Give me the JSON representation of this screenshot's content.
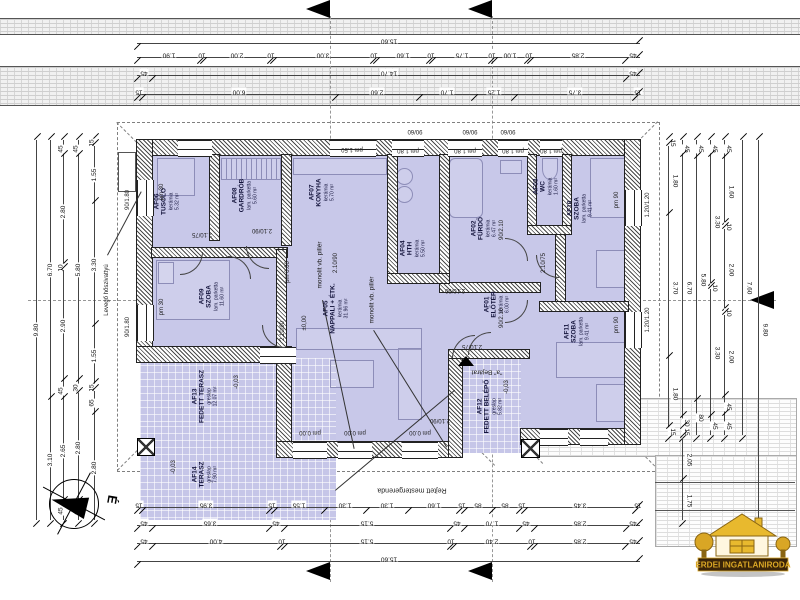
{
  "rooms": [
    {
      "code": "AF01",
      "name": "ELŐTÉR",
      "floor": "kerámia",
      "area": "6.00 m²"
    },
    {
      "code": "AF02",
      "name": "FÜRDŐ",
      "floor": "kerámia",
      "area": "6.47 m²"
    },
    {
      "code": "AF03",
      "name": "WC",
      "floor": "kerámia",
      "area": "1.60 m²"
    },
    {
      "code": "AF04",
      "name": "HTH",
      "floor": "kerámia",
      "area": "5.50 m²"
    },
    {
      "code": "AF05",
      "name": "NAPPALI + ÉTK.",
      "floor": "kerámia",
      "area": "31.96 m²"
    },
    {
      "code": "AF06",
      "name": "TUSOLÓ",
      "floor": "kerámia",
      "area": "5.32 m²"
    },
    {
      "code": "AF07",
      "name": "KONYHA",
      "floor": "kerámia",
      "area": "5.70 m²"
    },
    {
      "code": "AF08",
      "name": "GARDRÓB",
      "floor": "lam. parketta",
      "area": "5.60 m²"
    },
    {
      "code": "AF09",
      "name": "SZOBA",
      "floor": "lam. parketta",
      "area": "11.60 m²"
    },
    {
      "code": "AF10",
      "name": "SZOBA",
      "floor": "lam. parketta",
      "area": "9.41 m²"
    },
    {
      "code": "AF11",
      "name": "SZOBA",
      "floor": "lam. parketta",
      "area": "9.41 m²"
    },
    {
      "code": "AF12",
      "name": "FEDETT BELÉPŐ",
      "floor": "greslap",
      "area": "5.82 m²"
    },
    {
      "code": "AF13",
      "name": "FEDETT TERASZ",
      "floor": "greslap",
      "area": "12.07 m²"
    },
    {
      "code": "AF14",
      "name": "TERASZ",
      "floor": "greslap",
      "area": "7.90 m²"
    }
  ],
  "annotations": {
    "pillar": "monolit vb. pillér",
    "heat_pump": "Levegő hőszivattyú",
    "hidden_beam": "Rejtett mestergerenda",
    "entrance": "\"a\" Bejárat",
    "north": "É"
  },
  "small_labels": [
    "pm 1.50",
    "pm 1.80",
    "pm 1.80",
    "pm 1.80",
    "pm 1.80",
    "90/60",
    "90/60",
    "90/60",
    "pm 30",
    "pm 30",
    "pm 90",
    "pm 90",
    "90/1.80",
    "90/1.80",
    "pm 0.00",
    "pm 0.00",
    "pm 0.00",
    "pm 0.00",
    "±0,00",
    "-0,03",
    "-0,03",
    "-0,03",
    "2.10/75",
    "2.10/90",
    "2.10/90",
    "2.10/75",
    "2.10/75",
    "2.10/90",
    "2.10/90",
    "90/2.10",
    "90/2.10",
    "1.20/1.20",
    "1.20/1.20",
    "2.10/90"
  ],
  "dims": {
    "top_total": [
      "15.60"
    ],
    "top_a": [
      "1.90",
      "10",
      "2.00",
      "10",
      "3.00",
      "10",
      "1.60",
      "10",
      "1.75",
      "10",
      "1.00",
      "10",
      "2.85",
      "45"
    ],
    "top_b": [
      "45",
      "14.70",
      "45"
    ],
    "top_c": [
      "15",
      "6.00",
      "2.60",
      "1.70",
      "1.25",
      "3.75",
      "15"
    ],
    "bottom_1": [
      "15",
      "3.95",
      "15",
      "1.55",
      "1.30",
      "1.30",
      "1.60",
      "15",
      "85",
      "85",
      "15",
      "3.45",
      "15"
    ],
    "bottom_2": [
      "45",
      "3.65",
      "45",
      "5.15",
      "45",
      "1.70",
      "45",
      "2.85",
      "45"
    ],
    "bottom_3": [
      "45",
      "4.00",
      "10",
      "5.15",
      "10",
      "2.40",
      "10",
      "2.85",
      "45"
    ],
    "bottom_total": [
      "15.60"
    ],
    "left_1": [
      "9.80"
    ],
    "left_2": [
      "6.70",
      "3.10"
    ],
    "left_3": [
      "45",
      "2.80",
      "10",
      "2.90",
      "45",
      "2.65",
      "45"
    ],
    "left_4": [
      "45",
      "5.80",
      "30",
      "2.80",
      "45"
    ],
    "left_5": [
      "15",
      "1.55",
      "3.30",
      "1.55",
      "15",
      "65",
      "2.80"
    ],
    "right_1": [
      "15",
      "1.80",
      "3.70",
      "1.80",
      "15"
    ],
    "right_2": [
      "45",
      "6.70",
      "30",
      "15"
    ],
    "right_2b": [
      "2.05",
      "1.75"
    ],
    "right_3": [
      "45",
      "5.80",
      "80"
    ],
    "right_4": [
      "45",
      "3.30",
      "10",
      "3.30",
      "45"
    ],
    "right_5": [
      "45",
      "1.60",
      "10",
      "2.00",
      "10",
      "2.00",
      "45",
      "45"
    ],
    "right_6": [
      "7.60"
    ],
    "right_7": [
      "9.80"
    ]
  },
  "logo": {
    "text": "ERDEI INGATLANIRODA",
    "gold": "#d9a625",
    "brown": "#3a2408"
  },
  "colors": {
    "room_fill": "#c8c8e9",
    "wall_hatch": "#4a4a4a",
    "dim_line": "#444444"
  }
}
